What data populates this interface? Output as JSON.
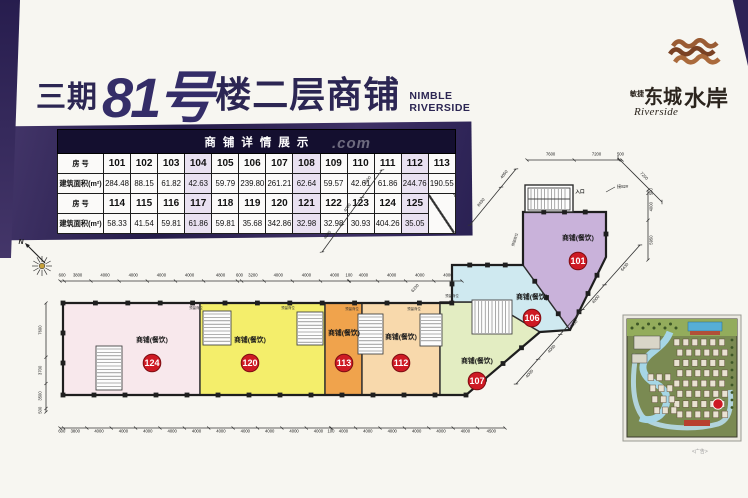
{
  "title": {
    "phase": "三期",
    "number": "81号",
    "suffix": "楼二层商铺",
    "en_line1": "NIMBLE",
    "en_line2": "RIVERSIDE"
  },
  "logo": {
    "prefix": "敏捷",
    "name1": "东城",
    "name2": "水岸",
    "en": "Riverside"
  },
  "table": {
    "header": "商铺详情展示",
    "label_no": "房 号",
    "label_area": "建筑面积(m²)",
    "group1": {
      "nos": [
        "101",
        "102",
        "103",
        "104",
        "105",
        "106",
        "107",
        "108",
        "109",
        "110",
        "111",
        "112",
        "113"
      ],
      "areas": [
        "284.48",
        "88.15",
        "61.82",
        "42.63",
        "59.79",
        "239.80",
        "261.21",
        "62.64",
        "59.57",
        "42.61",
        "61.86",
        "244.76",
        "190.55"
      ]
    },
    "group2": {
      "nos": [
        "114",
        "115",
        "116",
        "117",
        "118",
        "119",
        "120",
        "121",
        "122",
        "123",
        "124",
        "125"
      ],
      "areas": [
        "58.33",
        "41.54",
        "59.81",
        "61.86",
        "59.81",
        "35.68",
        "342.86",
        "32.98",
        "32.98",
        "30.93",
        "404.26",
        "35.05"
      ]
    }
  },
  "plan": {
    "unit_label": "商铺(餐饮)",
    "units": [
      {
        "no": "124",
        "color": "#f8e8ec"
      },
      {
        "no": "120",
        "color": "#f4ee6b"
      },
      {
        "no": "113",
        "color": "#f0a34c"
      },
      {
        "no": "112",
        "color": "#f8d9ac"
      },
      {
        "no": "107",
        "color": "#e3edc2"
      },
      {
        "no": "106",
        "color": "#cfe9f0"
      },
      {
        "no": "101",
        "color": "#c9b2da"
      }
    ],
    "circle_color": "#ce1a24",
    "reserved_label": "预留商位",
    "entrance_label": "入口",
    "adjacent_label": "接82#",
    "compass_label": "N",
    "dims": {
      "top": [
        "600",
        "3800",
        "4000",
        "4000",
        "4000",
        "4000",
        "4800",
        "600",
        "3200",
        "4000",
        "4000",
        "4000",
        "100",
        "4000",
        "4000",
        "4000",
        "4000"
      ],
      "bottom": [
        "600",
        "3800",
        "4000",
        "4000",
        "4000",
        "4000",
        "4000",
        "4000",
        "4000",
        "4000",
        "4000",
        "4000",
        "100",
        "4000",
        "4000",
        "4000",
        "4000",
        "4000",
        "4000",
        "4500"
      ],
      "left": [
        "7600",
        "3700",
        "3500",
        "500"
      ],
      "wing_top": [
        "7600",
        "7200",
        "500"
      ],
      "wing_right": [
        "500",
        "4000",
        "5950"
      ],
      "diag_left": [
        "4000",
        "4000",
        "4000"
      ],
      "diag_upper": [
        "8430",
        "4050"
      ],
      "diag_right": [
        "7200"
      ],
      "diag_lower": [
        "6430",
        "4000",
        "4000",
        "4000",
        "4000"
      ],
      "diag_extra": "6230"
    }
  },
  "watermark": ".com",
  "ad_note": "<广告>"
}
